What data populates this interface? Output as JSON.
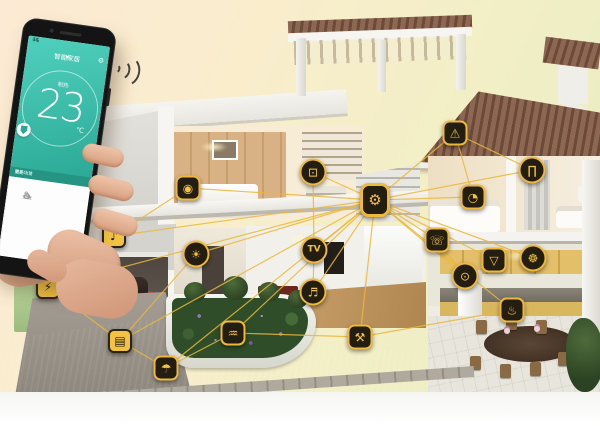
{
  "scene": {
    "description": "Smart home concept: cutaway 3D house with connected smart-device icons and a hand holding a phone with a thermostat app",
    "accent_color": "#f2c243",
    "line_color": "#eab83d",
    "phone_teal": "#2aa795"
  },
  "phone": {
    "battery": "74",
    "carrier": "4G",
    "header_title": "智能家居",
    "header_caret": "▾",
    "gear_glyph": "⚙",
    "mode_label": "制热",
    "temp_value": "23",
    "temp_unit": "℃",
    "strip_left": "智能场景",
    "strip_right": "更多",
    "panel_items": [
      {
        "icon": "⌂",
        "label": "安防"
      },
      {
        "icon": "✎",
        "label": "灯光"
      }
    ]
  },
  "network": {
    "nodes": [
      {
        "id": "hub",
        "name": "smart-gateway",
        "glyph": "⚙",
        "x": 375,
        "y": 200,
        "shape": "square",
        "hub": true
      },
      {
        "id": "cam",
        "name": "bedroom-camera",
        "glyph": "◉",
        "x": 188,
        "y": 188,
        "shape": "square"
      },
      {
        "id": "speaker",
        "name": "audio-speaker",
        "glyph": "♪",
        "x": 114,
        "y": 236,
        "shape": "yellow"
      },
      {
        "id": "light",
        "name": "wall-light",
        "glyph": "☀",
        "x": 196,
        "y": 254,
        "shape": "circle"
      },
      {
        "id": "charger",
        "name": "ev-charger",
        "glyph": "⚡",
        "x": 48,
        "y": 287,
        "shape": "yellow"
      },
      {
        "id": "garage",
        "name": "garage-door",
        "glyph": "▤",
        "x": 120,
        "y": 341,
        "shape": "yellow"
      },
      {
        "id": "irrigation",
        "name": "irrigation",
        "glyph": "☂",
        "x": 166,
        "y": 368,
        "shape": "square"
      },
      {
        "id": "sprinkler",
        "name": "garden-sprinkler",
        "glyph": "♒",
        "x": 233,
        "y": 333,
        "shape": "square"
      },
      {
        "id": "tv",
        "name": "television",
        "glyph": "TV",
        "x": 314,
        "y": 250,
        "shape": "circle tvtxt"
      },
      {
        "id": "stereo",
        "name": "stereo-speaker",
        "glyph": "♬",
        "x": 313,
        "y": 292,
        "shape": "circle"
      },
      {
        "id": "mower",
        "name": "lawn-mower",
        "glyph": "⚒",
        "x": 360,
        "y": 337,
        "shape": "square"
      },
      {
        "id": "computer",
        "name": "study-computer",
        "glyph": "⊡",
        "x": 313,
        "y": 172,
        "shape": "circle"
      },
      {
        "id": "alarm",
        "name": "roof-alarm",
        "glyph": "⚠",
        "x": 455,
        "y": 133,
        "shape": "square"
      },
      {
        "id": "curtain",
        "name": "smart-curtain",
        "glyph": "∏",
        "x": 532,
        "y": 170,
        "shape": "circle"
      },
      {
        "id": "thermostat",
        "name": "thermostat",
        "glyph": "◔",
        "x": 473,
        "y": 197,
        "shape": "square"
      },
      {
        "id": "doorphone",
        "name": "door-phone",
        "glyph": "☏",
        "x": 437,
        "y": 240,
        "shape": "square"
      },
      {
        "id": "washer",
        "name": "washing-machine",
        "glyph": "⊙",
        "x": 465,
        "y": 276,
        "shape": "circle"
      },
      {
        "id": "hood",
        "name": "range-hood",
        "glyph": "▽",
        "x": 494,
        "y": 260,
        "shape": "square"
      },
      {
        "id": "fan",
        "name": "exhaust-fan",
        "glyph": "☸",
        "x": 533,
        "y": 258,
        "shape": "circle"
      },
      {
        "id": "oven",
        "name": "smart-oven",
        "glyph": "♨",
        "x": 512,
        "y": 310,
        "shape": "square"
      }
    ],
    "links": [
      [
        "hub",
        "cam"
      ],
      [
        "hub",
        "speaker"
      ],
      [
        "hub",
        "light"
      ],
      [
        "hub",
        "charger"
      ],
      [
        "hub",
        "garage"
      ],
      [
        "hub",
        "irrigation"
      ],
      [
        "hub",
        "sprinkler"
      ],
      [
        "hub",
        "tv"
      ],
      [
        "hub",
        "stereo"
      ],
      [
        "hub",
        "mower"
      ],
      [
        "hub",
        "computer"
      ],
      [
        "hub",
        "alarm"
      ],
      [
        "hub",
        "curtain"
      ],
      [
        "hub",
        "thermostat"
      ],
      [
        "hub",
        "doorphone"
      ],
      [
        "hub",
        "washer"
      ],
      [
        "hub",
        "hood"
      ],
      [
        "hub",
        "fan"
      ],
      [
        "hub",
        "oven"
      ],
      [
        "speaker",
        "charger"
      ],
      [
        "charger",
        "garage"
      ],
      [
        "garage",
        "irrigation"
      ],
      [
        "irrigation",
        "sprinkler"
      ],
      [
        "sprinkler",
        "mower"
      ],
      [
        "mower",
        "oven"
      ],
      [
        "alarm",
        "thermostat"
      ],
      [
        "alarm",
        "curtain"
      ],
      [
        "tv",
        "stereo"
      ],
      [
        "cam",
        "speaker"
      ],
      [
        "doorphone",
        "washer"
      ],
      [
        "light",
        "garage"
      ],
      [
        "computer",
        "tv"
      ]
    ]
  }
}
